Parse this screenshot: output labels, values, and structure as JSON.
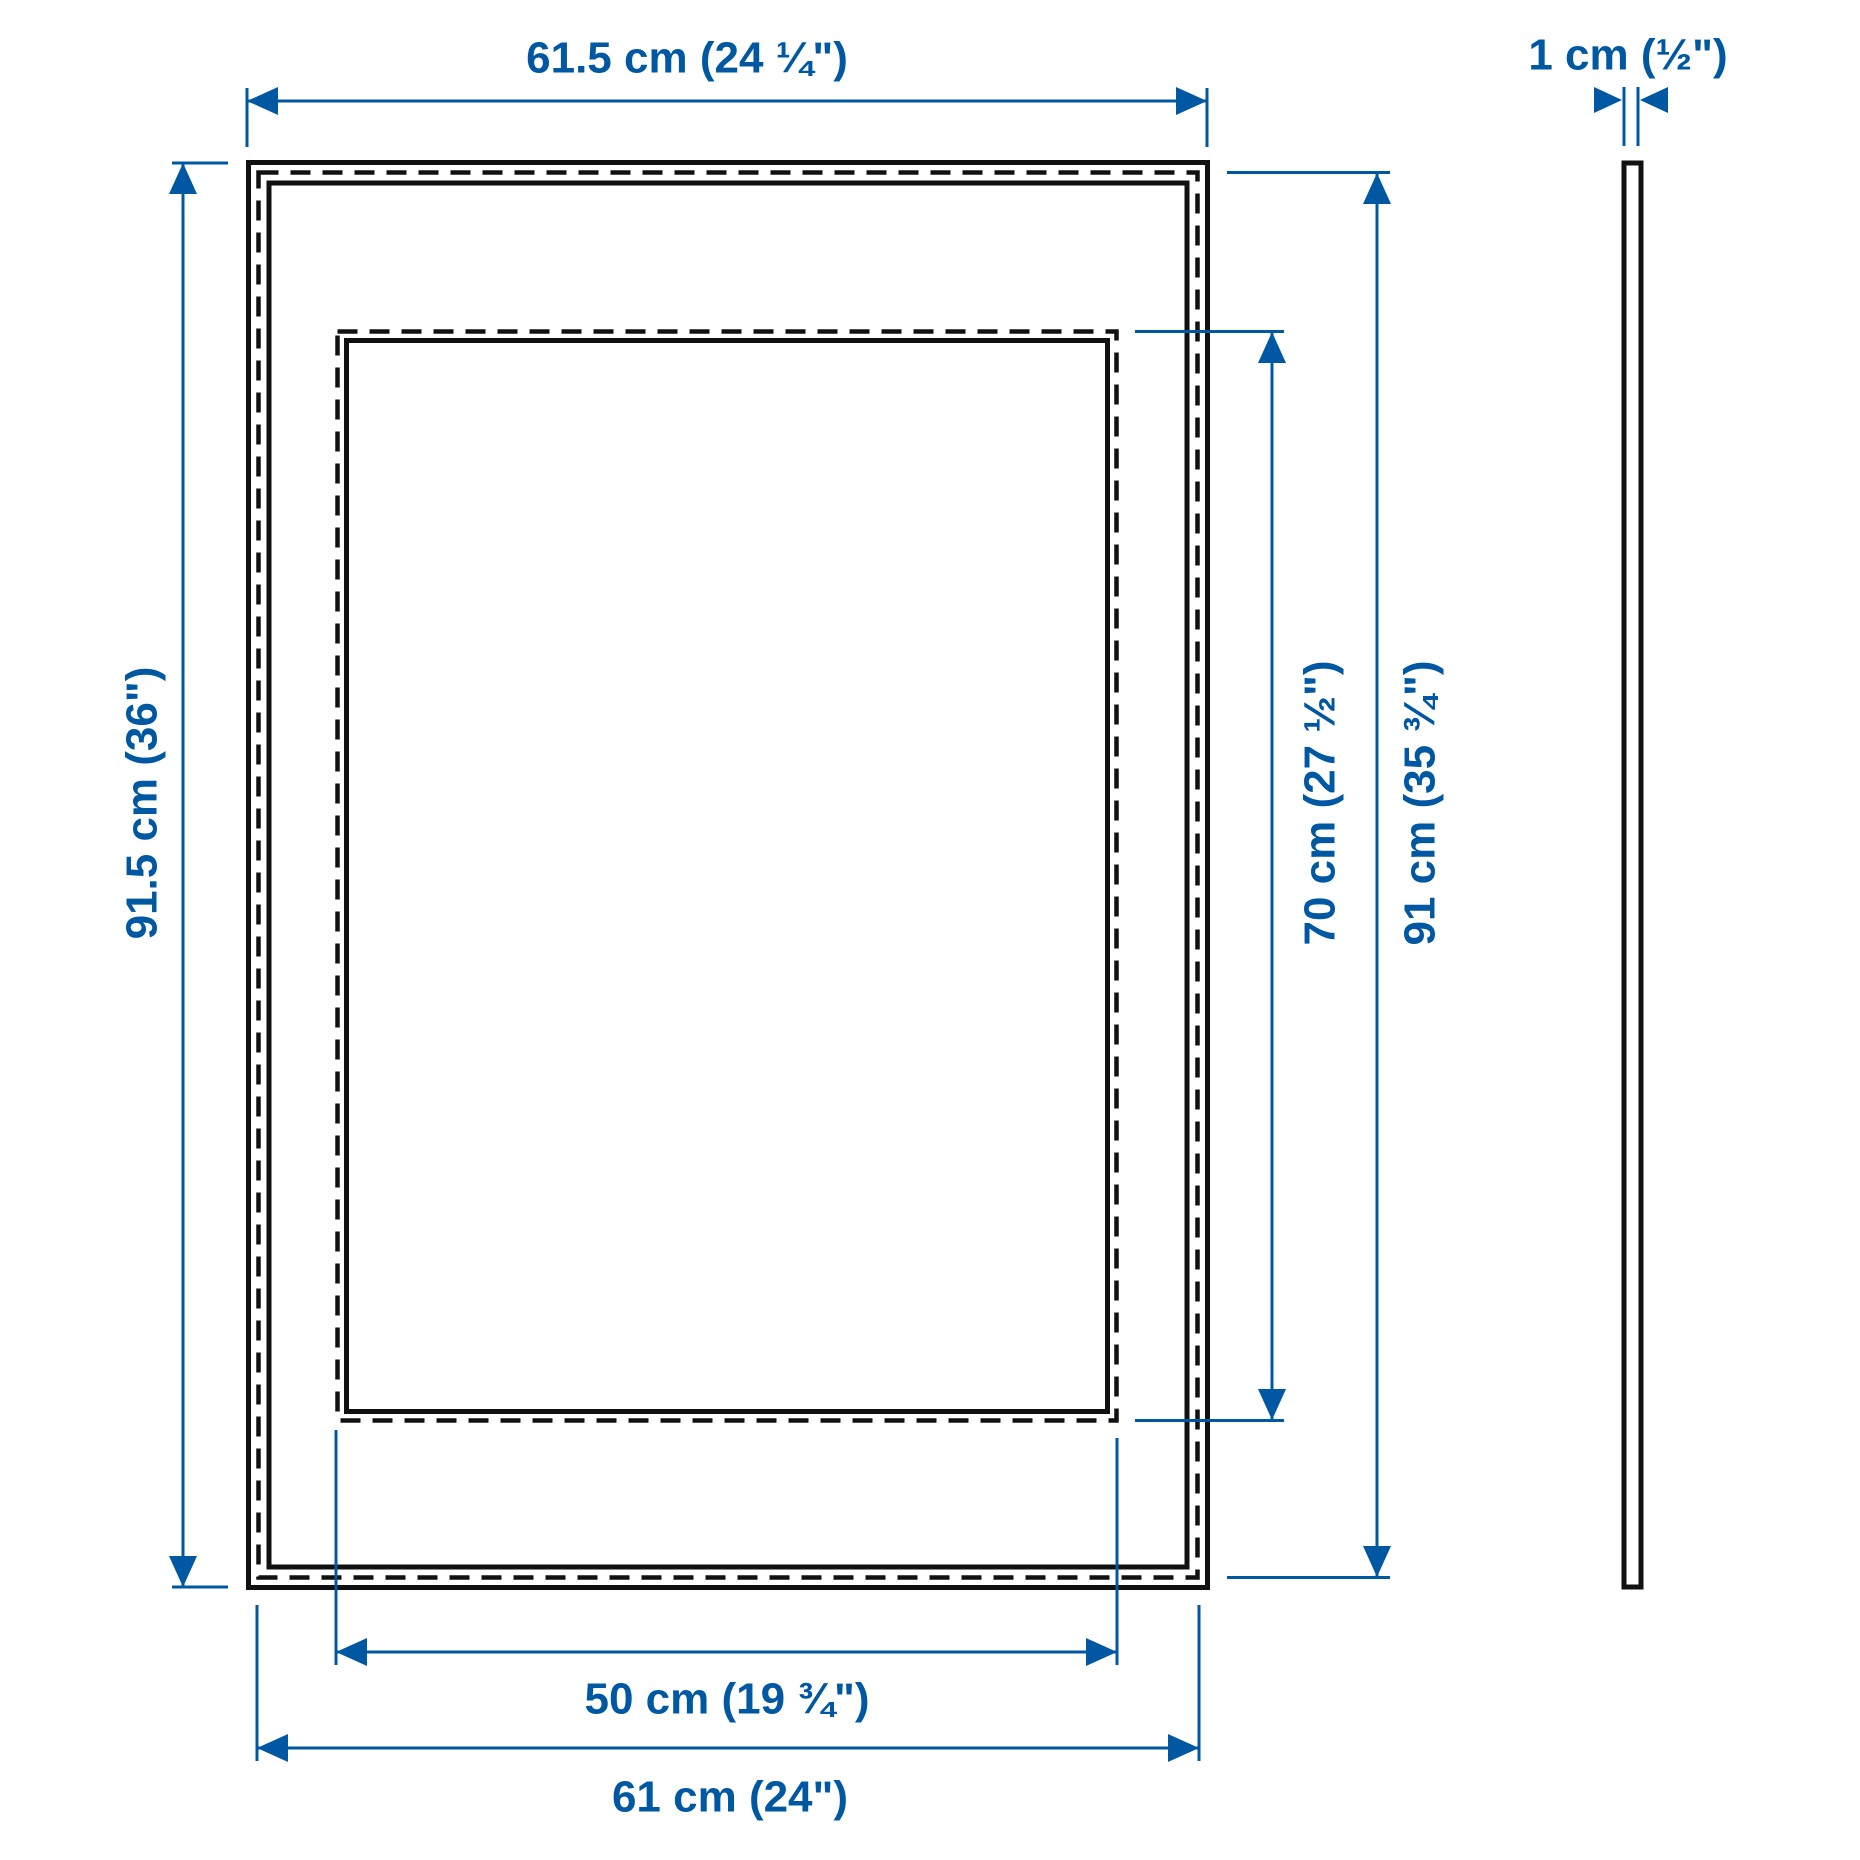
{
  "diagram": {
    "product_views": {
      "front_view": "frame-front-view",
      "side_view": "frame-side-view"
    },
    "dimensions": {
      "outer_width": "61.5 cm (24 ¼\")",
      "outer_height": "91.5 cm (36\")",
      "visible_picture_height": "70 cm (27 ½\")",
      "picture_height": "91 cm (35 ¾\")",
      "visible_picture_width": "50 cm (19 ¾\")",
      "picture_width": "61 cm (24\")",
      "thickness": "1 cm (½\")"
    },
    "colors": {
      "dimension": "#0058a3",
      "outline": "#111111",
      "background": "#ffffff"
    }
  }
}
